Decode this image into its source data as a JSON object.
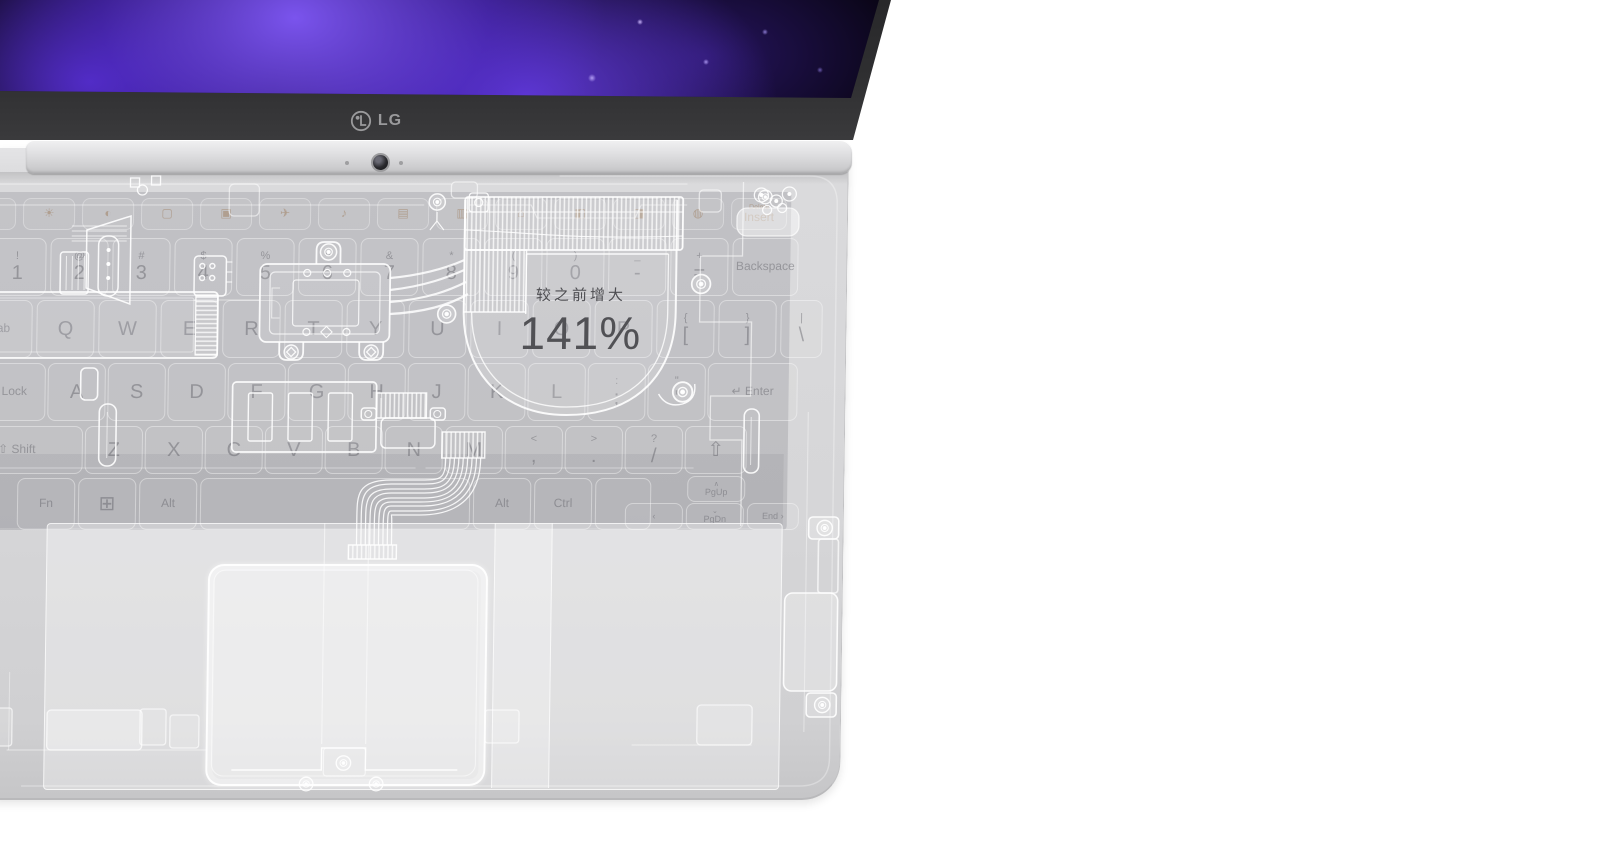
{
  "product": {
    "brand": "LG",
    "logo_text": "LG"
  },
  "callout": {
    "label": "较之前增大",
    "value": "141%"
  },
  "colors": {
    "page_bg": "#ffffff",
    "bezel": "#2f2f31",
    "hinge_silver": "#dededf",
    "body_gray": "#d6d6d8",
    "keyboard_plate": "#c2c2c5",
    "component_outline": "#ffffff",
    "callout_text": "#4f4f53",
    "wallpaper_purple": "#6a3ce0",
    "wallpaper_black": "#07040f"
  },
  "keyboard": {
    "rows": [
      {
        "y": 26,
        "h": 30,
        "x": -35,
        "g": 9,
        "cls": "frow",
        "keys": [
          {
            "b": "◦",
            "w": 50
          },
          {
            "b": "☀",
            "w": 50
          },
          {
            "b": "◐",
            "w": 50
          },
          {
            "b": "▢",
            "w": 50
          },
          {
            "b": "▣",
            "w": 50
          },
          {
            "b": "✈",
            "w": 50
          },
          {
            "b": "♪",
            "w": 50
          },
          {
            "b": "▤",
            "w": 50
          },
          {
            "b": "▥",
            "w": 50
          },
          {
            "b": "⌂",
            "w": 50
          },
          {
            "b": "◧",
            "w": 50
          },
          {
            "b": "◨",
            "w": 50
          },
          {
            "b": "◍",
            "w": 50
          },
          {
            "t": "Delete",
            "b": "Insert",
            "w": 54,
            "cls": "tiny"
          }
        ]
      },
      {
        "y": 66,
        "h": 56,
        "x": -10,
        "g": 6,
        "keys": [
          {
            "t": "!",
            "b": "1"
          },
          {
            "t": "@",
            "b": "2"
          },
          {
            "t": "#",
            "b": "3"
          },
          {
            "t": "$",
            "b": "4"
          },
          {
            "t": "%",
            "b": "5"
          },
          {
            "t": "^",
            "b": "6"
          },
          {
            "t": "&",
            "b": "7"
          },
          {
            "t": "*",
            "b": "8"
          },
          {
            "t": "(",
            "b": "9"
          },
          {
            "t": ")",
            "b": "0"
          },
          {
            "t": "_",
            "b": "-"
          },
          {
            "t": "+",
            "b": "="
          },
          {
            "b": "Backspace",
            "w": 64,
            "cls": "small"
          }
        ]
      },
      {
        "y": 128,
        "h": 56,
        "x": -29,
        "g": 6,
        "keys": [
          {
            "b": "Tab",
            "w": 62,
            "cls": "small"
          },
          {
            "b": "Q"
          },
          {
            "b": "W"
          },
          {
            "b": "E"
          },
          {
            "b": "R"
          },
          {
            "b": "T"
          },
          {
            "b": "Y"
          },
          {
            "b": "U"
          },
          {
            "b": "I"
          },
          {
            "b": "O"
          },
          {
            "b": "P"
          },
          {
            "t": "{",
            "b": "["
          },
          {
            "t": "}",
            "b": "]"
          },
          {
            "t": "|",
            "b": "\\",
            "w": 40
          }
        ]
      },
      {
        "y": 191,
        "h": 56,
        "x": -45,
        "g": 4,
        "keys": [
          {
            "b": "Caps Lock",
            "w": 92,
            "cls": "small"
          },
          {
            "b": "A"
          },
          {
            "b": "S"
          },
          {
            "b": "D"
          },
          {
            "b": "F"
          },
          {
            "b": "G"
          },
          {
            "b": "H"
          },
          {
            "b": "J"
          },
          {
            "b": "K"
          },
          {
            "b": "L"
          },
          {
            "t": ":",
            "b": ";"
          },
          {
            "t": "\"",
            "b": "'"
          },
          {
            "b": "↵  Enter",
            "w": 88,
            "cls": "small"
          }
        ]
      },
      {
        "y": 254,
        "h": 46,
        "x": -45,
        "g": 4,
        "keys": [
          {
            "b": "⇧  Shift",
            "w": 130,
            "cls": "small"
          },
          {
            "b": "Z"
          },
          {
            "b": "X"
          },
          {
            "b": "C"
          },
          {
            "b": "V"
          },
          {
            "b": "B"
          },
          {
            "b": "N"
          },
          {
            "b": "M"
          },
          {
            "t": "<",
            "b": ","
          },
          {
            "t": ">",
            "b": "."
          },
          {
            "t": "?",
            "b": "/"
          },
          {
            "b": "⇧",
            "w": 60
          }
        ]
      },
      {
        "y": 306,
        "h": 50,
        "x": 22,
        "g": 5,
        "keys": [
          {
            "b": "Fn",
            "cls": "small"
          },
          {
            "b": "⊞"
          },
          {
            "b": "Alt",
            "cls": "small"
          },
          {
            "b": "",
            "w": 268
          },
          {
            "b": "Alt",
            "cls": "small"
          },
          {
            "b": "Ctrl",
            "cls": "small"
          },
          {
            "b": "",
            "w": 54
          }
        ]
      },
      {
        "y": 304,
        "h": 24,
        "x": 692,
        "g": 5,
        "keys": [
          {
            "t": "∧",
            "b": "PgUp",
            "w": 56,
            "cls": "tiny"
          }
        ]
      },
      {
        "y": 331,
        "h": 25,
        "x": 630,
        "g": 5,
        "keys": [
          {
            "b": "‹",
            "w": 56,
            "cls": "tiny"
          },
          {
            "t": "⌄",
            "b": "PgDn",
            "w": 56,
            "cls": "tiny"
          },
          {
            "b": "End ›",
            "w": 50,
            "cls": "tiny"
          }
        ]
      }
    ]
  }
}
